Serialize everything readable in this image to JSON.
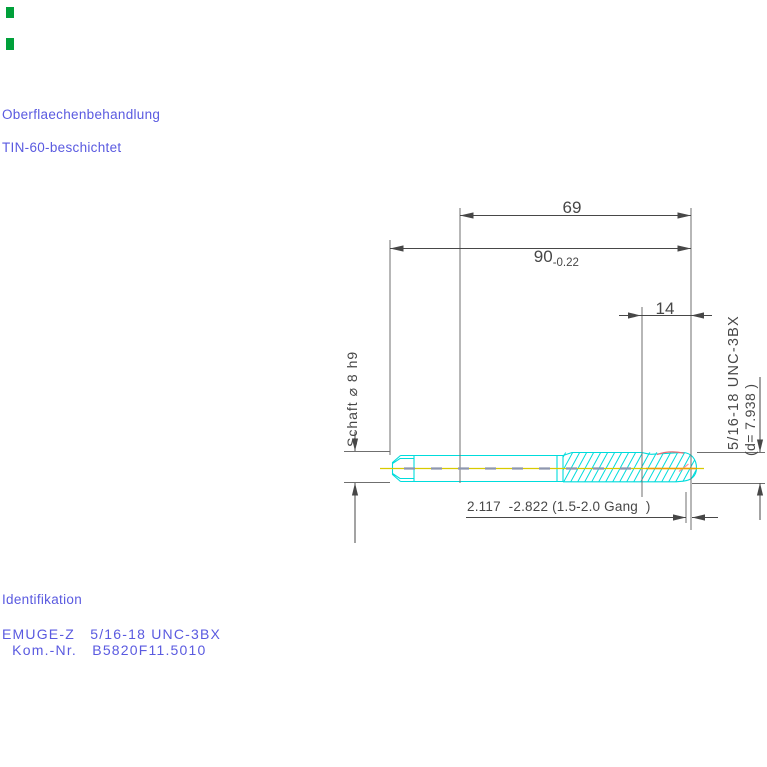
{
  "colors": {
    "blue_text": "#5a5ae0",
    "drawing_gray": "#474747",
    "ext_gray": "#6f6f6f",
    "tool_cyan": "#00dcdc",
    "centerline_yellow": "#d8ca00",
    "centerline_orange": "#efa000",
    "centerline_dash_slate": "#8e96ae",
    "thread_red": "#ee6a72",
    "thread_red_light": "#ff93a0",
    "mark_green": "#00a03a"
  },
  "surface_treatment": {
    "title": "Oberflaechenbehandlung",
    "value": "TIN-60-beschichtet"
  },
  "identification": {
    "title": "Identifikation",
    "product_line": "EMUGE-Z   5/16-18 UNC-3BX",
    "order_line": "  Kom.-Nr.   B5820F11.5010"
  },
  "dimensions": {
    "thread_ground_length": "69",
    "overall_length": "90",
    "overall_length_tolerance": "-0.22",
    "thread_length": "14",
    "shank_label": "Schaft ⌀ 8 h9",
    "thread_spec_label": "5/16-18 UNC-3BX",
    "thread_diameter_label": "(d= 7.938 )",
    "chamfer_label": "2.117  -2.822 (1.5-2.0 Gang  )"
  }
}
